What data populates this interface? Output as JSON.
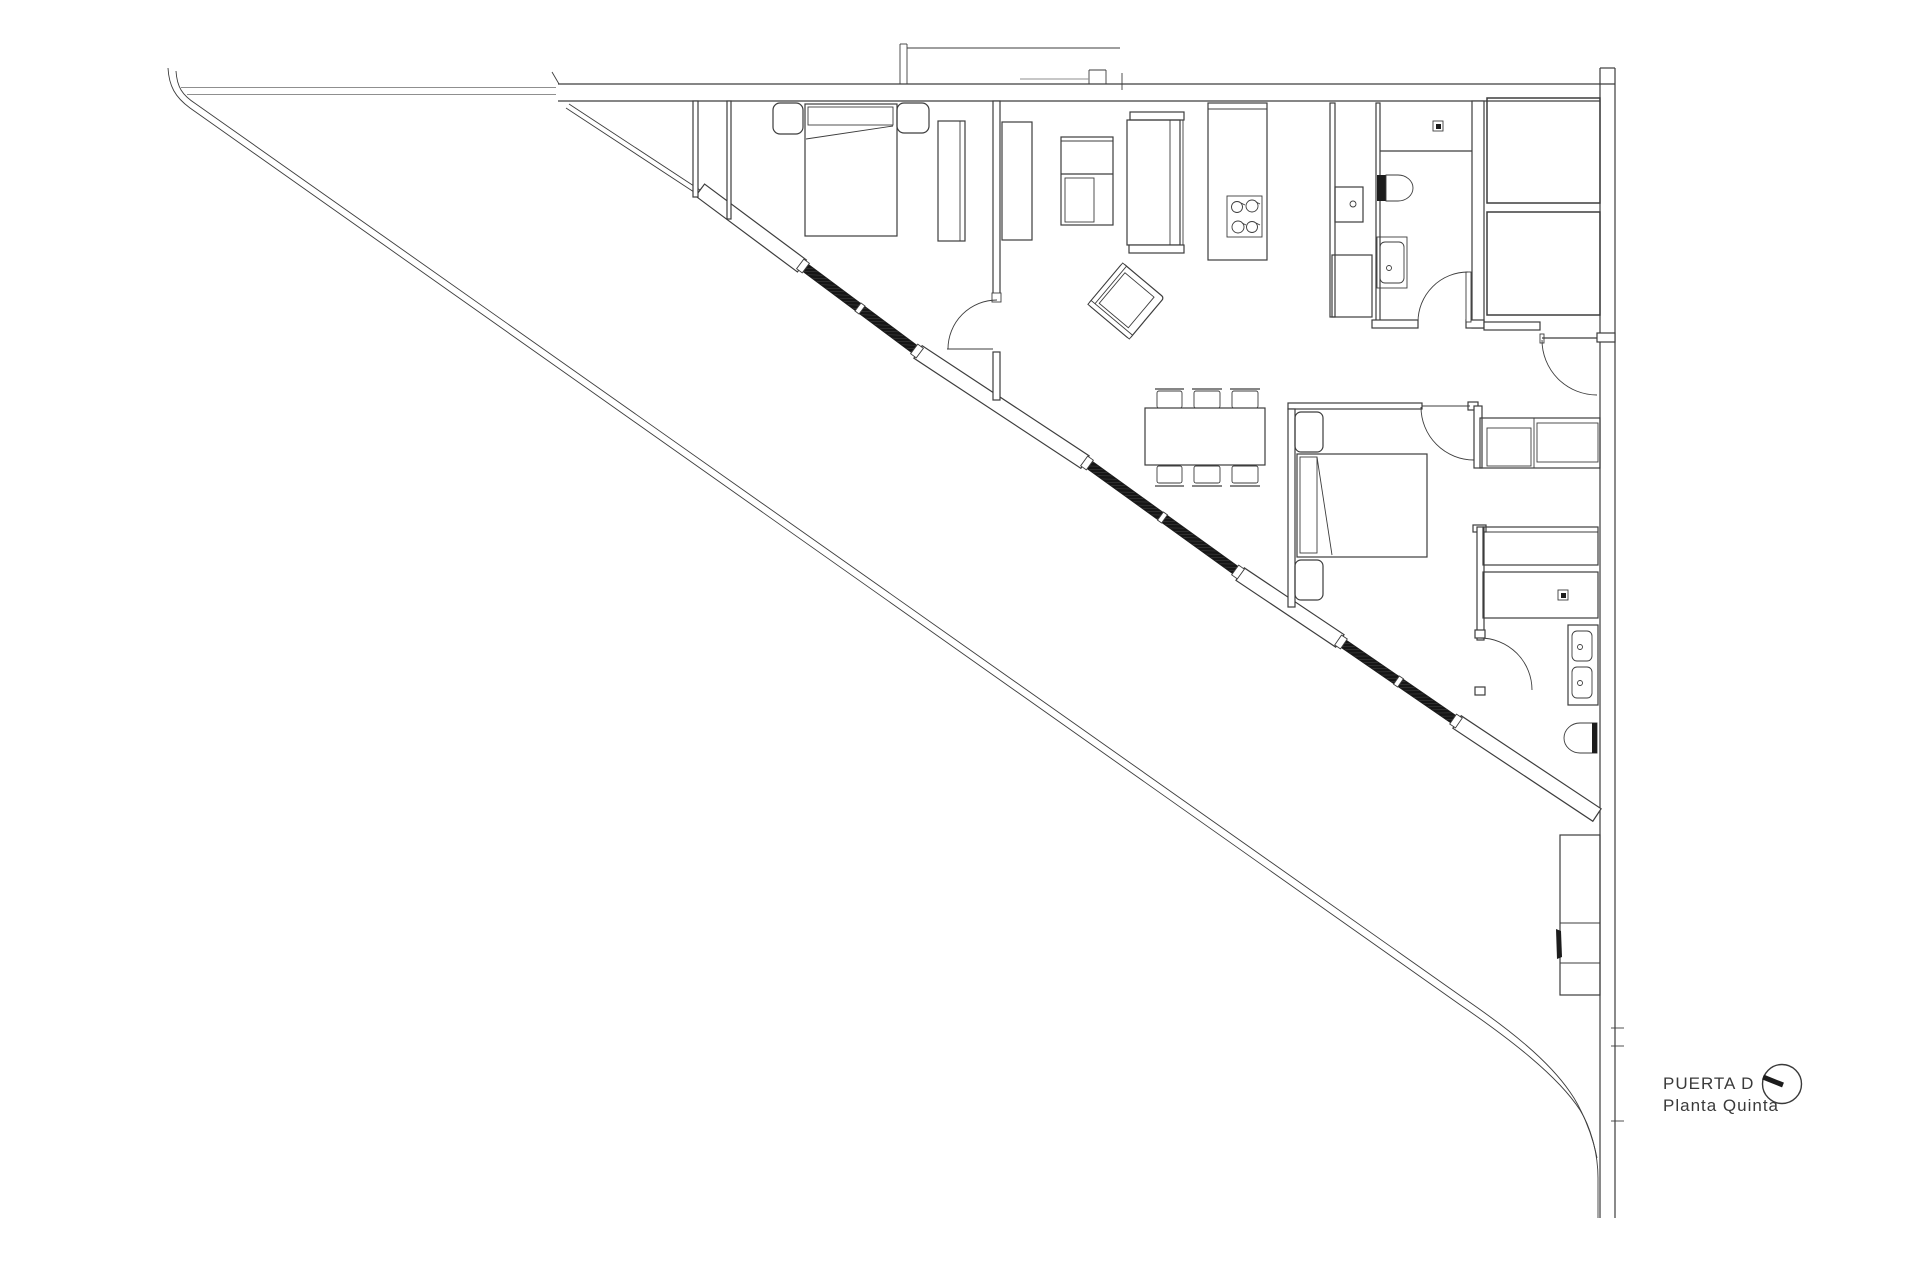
{
  "title_block": {
    "door_label": "PUERTA D",
    "floor_label": "Planta Quinta",
    "compass_icon": "north-indicator-circle"
  },
  "colors": {
    "background": "#ffffff",
    "line": "#3d3d3d",
    "glazing_dark": "#1c1c1c"
  },
  "drawing": {
    "type": "architectural-floor-plan",
    "rooms_visible": 0,
    "labels_visible": 2
  }
}
